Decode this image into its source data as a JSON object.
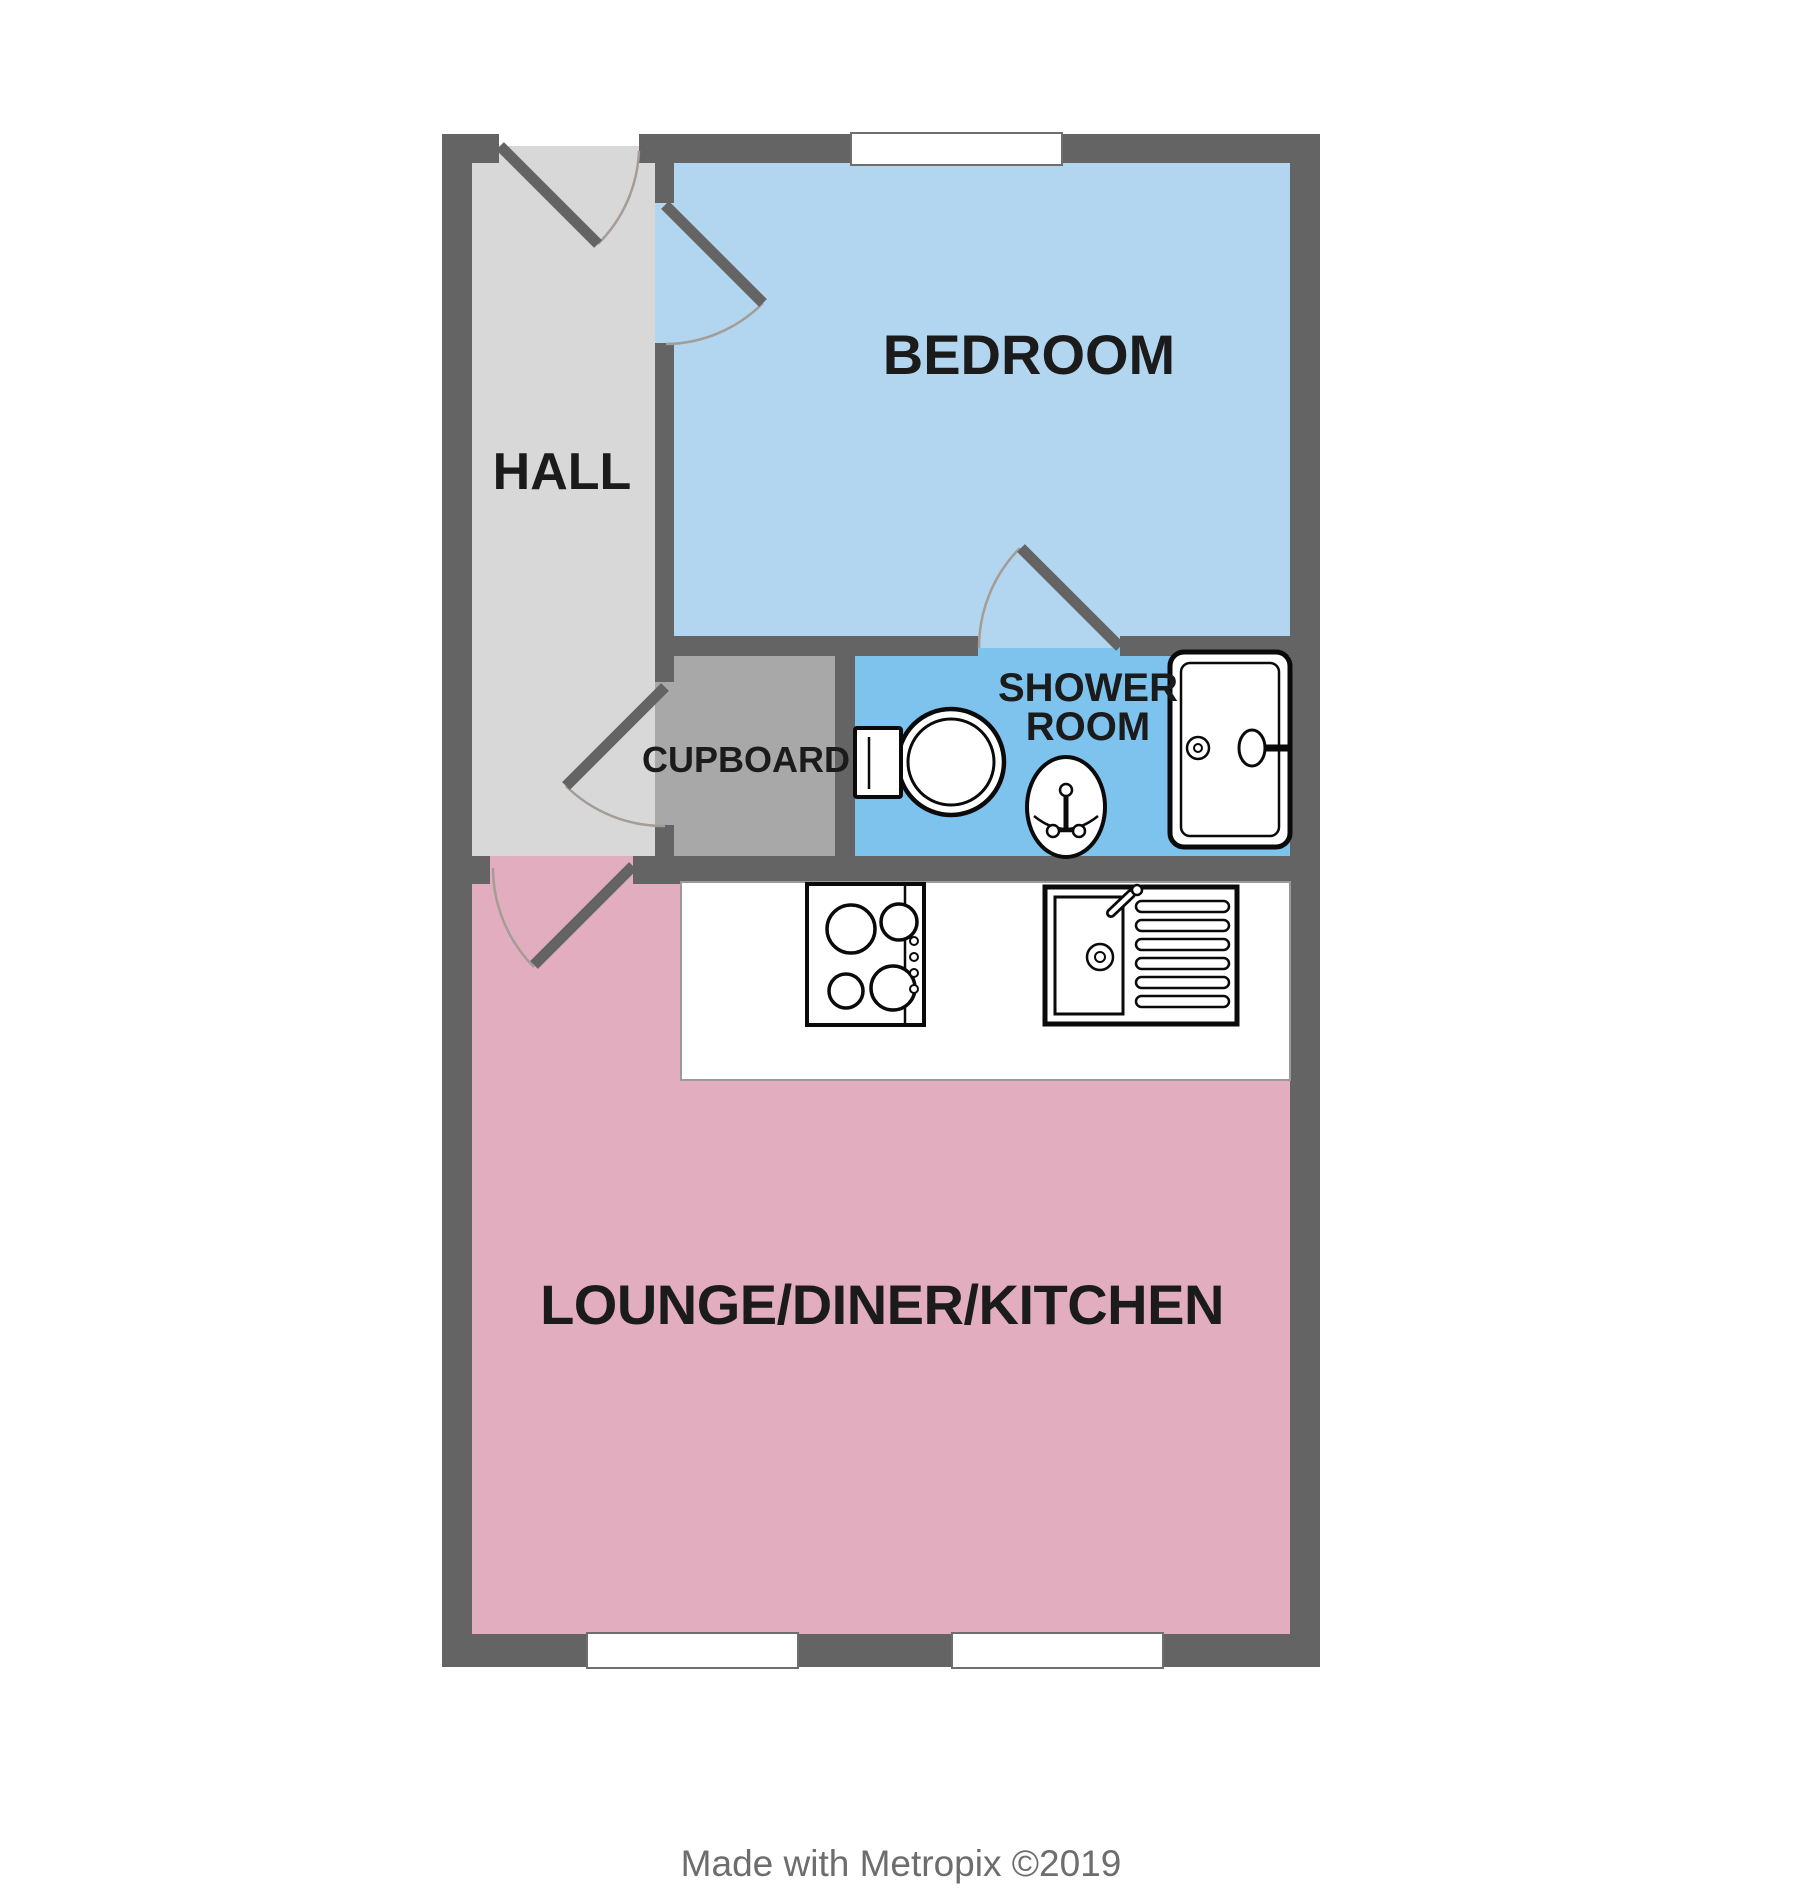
{
  "rooms": {
    "hall": {
      "label": "HALL",
      "color": "#d8d8d8"
    },
    "bedroom": {
      "label": "BEDROOM",
      "color": "#b2d6ef"
    },
    "cupboard": {
      "label": "CUPBOARD",
      "color": "#a8a8a8"
    },
    "shower_room": {
      "label_line1": "SHOWER",
      "label_line2": "ROOM",
      "color": "#7dc3ed"
    },
    "lounge": {
      "label": "LOUNGE/DINER/KITCHEN",
      "color": "#e2adbe"
    }
  },
  "fixtures": [
    "toilet",
    "basin",
    "shower-tray",
    "hob",
    "kitchen-sink"
  ],
  "windows": {
    "count": 3
  },
  "doors": {
    "count": 5
  },
  "colors": {
    "wall": "#646464",
    "window_fill": "#ffffff",
    "window_border": "#6e6e6e",
    "door_leaf": "#646464",
    "door_arc": "#a39d96",
    "fixture_outline": "#0a0a0a",
    "counter_border": "#9a9a9a",
    "label_text": "#1b1b1b",
    "footer_text": "#6d6d6d",
    "background": "#ffffff"
  },
  "footer": {
    "credit": "Made with Metropix ©2019"
  }
}
